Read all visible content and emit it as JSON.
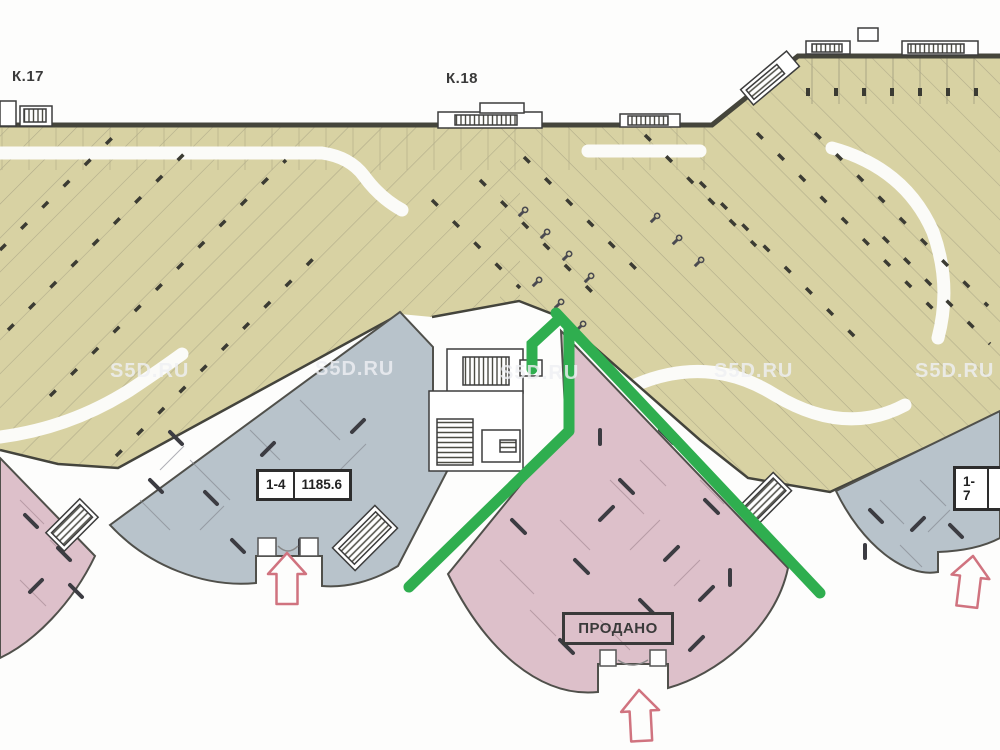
{
  "labels": {
    "k17": "К.17",
    "k18": "К.18"
  },
  "units": {
    "left": {
      "number": "1-4",
      "area": "1185.6"
    },
    "center": {
      "status": "ПРОДАНО"
    },
    "right": {
      "number": "1-7",
      "area": ""
    }
  },
  "watermark": "S5D.RU",
  "colors": {
    "parking": "#d8d2a3",
    "wing_blue": "#b8c3cb",
    "wing_pink": "#ddc0ca",
    "route_green": "#2fae4f",
    "arrow_red": "#d0737f",
    "wall": "#45453b"
  }
}
